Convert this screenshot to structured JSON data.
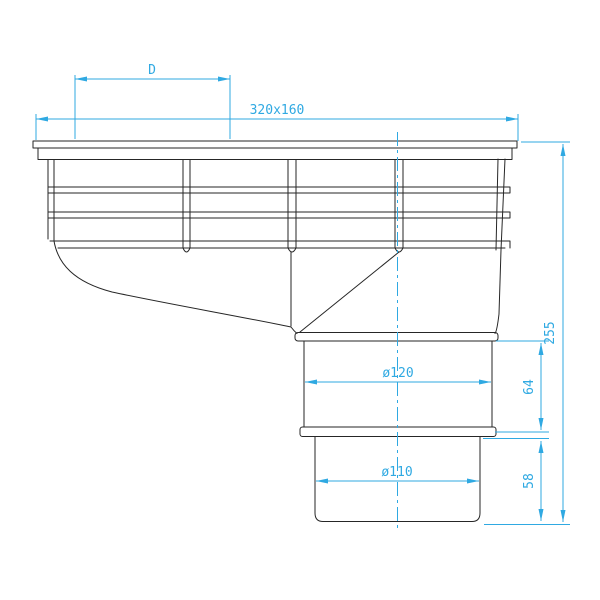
{
  "drawing": {
    "colors": {
      "outline": "#262626",
      "dimension": "#2fa9e2",
      "background": "#ffffff"
    },
    "dimensions": {
      "d_label": "D",
      "grate_size": "320x160",
      "overall_height": "255",
      "socket_diameter": "ø120",
      "socket_height": "64",
      "outlet_diameter": "ø110",
      "outlet_height": "58"
    }
  }
}
